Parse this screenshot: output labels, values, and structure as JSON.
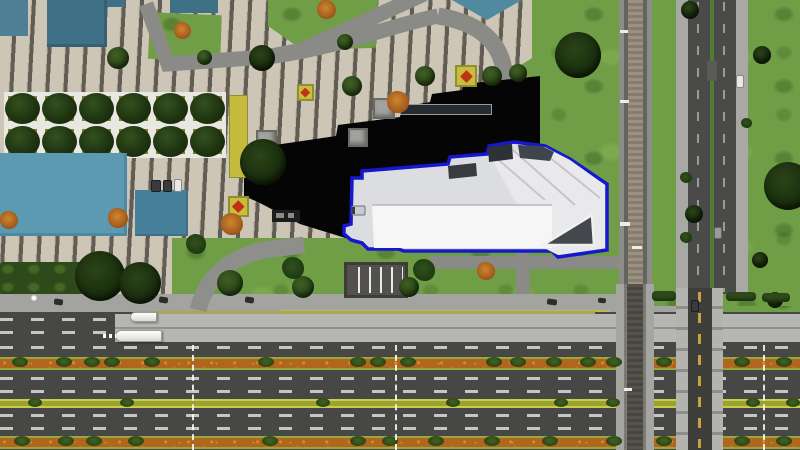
{
  "meta": {
    "view": "aerial-city-simulation",
    "description": "Top-down rendered city block: pedestrian plaza with striped paving, tree park grid, teal rooftops, a black rooftop building, a white building selected with a blue footprint outline, grass field, vertical railway line and divided street on the right, and a wide multi-carriageway boulevard with busway and planted medians at the bottom.",
    "canvas": {
      "width": 800,
      "height": 450
    }
  },
  "selection": {
    "selected_object": "white-building-footprint",
    "outline_color": "#1518cf"
  },
  "palette": {
    "grass": "#6f9e46",
    "plaza_tile": "#cdc5b5",
    "plaza_stripe": "#615d55",
    "path_gray": "#8a8a86",
    "sidewalk": "#a3a39f",
    "asphalt_dark": "#474745",
    "busway_concrete": "#b6b6b4",
    "lane_dash": "#c6c6c4",
    "median_orange": "#b0661e",
    "median_yellow_green": "#9aa231",
    "teal_roof": "#3e7086",
    "cyan_roof": "#5b9ab1",
    "black_roof": "#050505",
    "white_roof": "#ededef",
    "selection_blue": "#1518cf",
    "railway_bed": "#9a9183",
    "overpass_wall": "#b3b3b0",
    "center_line_yellow": "#c8a33d"
  },
  "scene": {
    "counts": {
      "buses": 2,
      "flowerbeds": 3,
      "kiosks": 3,
      "tree_park_cells": 12
    },
    "lane_marker_xs": [
      192,
      395,
      763
    ],
    "sprites": [
      {
        "cls": "kiosk",
        "x": 373,
        "y": 98,
        "w": 22,
        "h": 21
      },
      {
        "cls": "kiosk",
        "x": 348,
        "y": 128,
        "w": 20,
        "h": 19
      },
      {
        "cls": "kiosk",
        "x": 256,
        "y": 130,
        "w": 21,
        "h": 18
      },
      {
        "cls": "bench",
        "x": 400,
        "y": 104,
        "w": 92,
        "h": 11
      },
      {
        "cls": "flowerbed",
        "x": 455,
        "y": 65,
        "w": 22,
        "h": 22
      },
      {
        "cls": "flowerbed",
        "x": 297,
        "y": 84,
        "w": 17,
        "h": 17
      },
      {
        "cls": "flowerbed",
        "x": 228,
        "y": 196,
        "w": 21,
        "h": 21
      },
      {
        "cls": "planter",
        "x": 229,
        "y": 95,
        "w": 19,
        "h": 83
      },
      {
        "cls": "road-patch",
        "x": 707,
        "y": 61,
        "w": 10,
        "h": 20
      },
      {
        "cls": "tree",
        "x": 107,
        "y": 47,
        "w": 22,
        "h": 22
      },
      {
        "cls": "tree",
        "x": 197,
        "y": 50,
        "w": 15,
        "h": 15
      },
      {
        "cls": "tree",
        "x": 337,
        "y": 34,
        "w": 16,
        "h": 16
      },
      {
        "cls": "tree",
        "x": 342,
        "y": 76,
        "w": 20,
        "h": 20
      },
      {
        "cls": "tree",
        "x": 415,
        "y": 66,
        "w": 20,
        "h": 20
      },
      {
        "cls": "tree",
        "x": 482,
        "y": 66,
        "w": 20,
        "h": 20
      },
      {
        "cls": "tree",
        "x": 509,
        "y": 64,
        "w": 18,
        "h": 18
      },
      {
        "cls": "tree-dark",
        "x": 249,
        "y": 45,
        "w": 26,
        "h": 26
      },
      {
        "cls": "tree-dark",
        "x": 240,
        "y": 139,
        "w": 46,
        "h": 46
      },
      {
        "cls": "tree-dark",
        "x": 555,
        "y": 32,
        "w": 46,
        "h": 46
      },
      {
        "cls": "tree-dark",
        "x": 764,
        "y": 162,
        "w": 48,
        "h": 48
      },
      {
        "cls": "tree-dark",
        "x": 681,
        "y": 1,
        "w": 18,
        "h": 18
      },
      {
        "cls": "tree-dark",
        "x": 753,
        "y": 46,
        "w": 18,
        "h": 18
      },
      {
        "cls": "tree-dark",
        "x": 685,
        "y": 205,
        "w": 18,
        "h": 18
      },
      {
        "cls": "tree-dark",
        "x": 752,
        "y": 252,
        "w": 16,
        "h": 16
      },
      {
        "cls": "tree-dark",
        "x": 767,
        "y": 292,
        "w": 16,
        "h": 16
      },
      {
        "cls": "tree-dark",
        "x": 75,
        "y": 251,
        "w": 50,
        "h": 50
      },
      {
        "cls": "tree-dark",
        "x": 119,
        "y": 262,
        "w": 42,
        "h": 42
      },
      {
        "cls": "tree",
        "x": 217,
        "y": 270,
        "w": 26,
        "h": 26
      },
      {
        "cls": "tree",
        "x": 292,
        "y": 276,
        "w": 22,
        "h": 22
      },
      {
        "cls": "tree",
        "x": 399,
        "y": 277,
        "w": 20,
        "h": 20
      },
      {
        "cls": "bush-orange",
        "x": 174,
        "y": 22,
        "w": 17,
        "h": 17
      },
      {
        "cls": "bush-orange",
        "x": 317,
        "y": 0,
        "w": 19,
        "h": 19
      },
      {
        "cls": "bush-orange",
        "x": 387,
        "y": 91,
        "w": 22,
        "h": 22
      },
      {
        "cls": "bush-orange",
        "x": 221,
        "y": 213,
        "w": 22,
        "h": 22
      },
      {
        "cls": "bush-orange",
        "x": 0,
        "y": 211,
        "w": 18,
        "h": 18
      },
      {
        "cls": "bush-orange",
        "x": 108,
        "y": 208,
        "w": 20,
        "h": 20
      },
      {
        "cls": "bush-orange",
        "x": 477,
        "y": 262,
        "w": 18,
        "h": 18
      },
      {
        "cls": "bush-dark",
        "x": 186,
        "y": 234,
        "w": 20,
        "h": 20
      },
      {
        "cls": "bush-dark",
        "x": 282,
        "y": 257,
        "w": 22,
        "h": 22
      },
      {
        "cls": "bush-dark",
        "x": 413,
        "y": 259,
        "w": 22,
        "h": 22
      },
      {
        "cls": "bush-dark",
        "x": 680,
        "y": 172,
        "w": 12,
        "h": 11
      },
      {
        "cls": "bush-dark",
        "x": 680,
        "y": 232,
        "w": 12,
        "h": 11
      },
      {
        "cls": "bush-dark",
        "x": 741,
        "y": 118,
        "w": 11,
        "h": 10
      },
      {
        "cls": "hedge",
        "x": 652,
        "y": 291,
        "w": 24,
        "h": 10
      },
      {
        "cls": "hedge",
        "x": 726,
        "y": 292,
        "w": 30,
        "h": 9
      },
      {
        "cls": "hedge",
        "x": 762,
        "y": 293,
        "w": 28,
        "h": 9
      },
      {
        "cls": "shrub",
        "x": 12,
        "y": 357,
        "w": 16,
        "h": 10
      },
      {
        "cls": "shrub",
        "x": 56,
        "y": 357,
        "w": 16,
        "h": 10
      },
      {
        "cls": "shrub",
        "x": 84,
        "y": 357,
        "w": 16,
        "h": 10
      },
      {
        "cls": "shrub",
        "x": 104,
        "y": 357,
        "w": 16,
        "h": 10
      },
      {
        "cls": "shrub",
        "x": 144,
        "y": 357,
        "w": 16,
        "h": 10
      },
      {
        "cls": "shrub",
        "x": 258,
        "y": 357,
        "w": 16,
        "h": 10
      },
      {
        "cls": "shrub",
        "x": 350,
        "y": 357,
        "w": 16,
        "h": 10
      },
      {
        "cls": "shrub",
        "x": 370,
        "y": 357,
        "w": 16,
        "h": 10
      },
      {
        "cls": "shrub",
        "x": 400,
        "y": 357,
        "w": 16,
        "h": 10
      },
      {
        "cls": "shrub",
        "x": 486,
        "y": 357,
        "w": 16,
        "h": 10
      },
      {
        "cls": "shrub",
        "x": 510,
        "y": 357,
        "w": 16,
        "h": 10
      },
      {
        "cls": "shrub",
        "x": 546,
        "y": 357,
        "w": 16,
        "h": 10
      },
      {
        "cls": "shrub",
        "x": 580,
        "y": 357,
        "w": 16,
        "h": 10
      },
      {
        "cls": "shrub",
        "x": 606,
        "y": 357,
        "w": 16,
        "h": 10
      },
      {
        "cls": "shrub",
        "x": 656,
        "y": 357,
        "w": 16,
        "h": 10
      },
      {
        "cls": "shrub",
        "x": 734,
        "y": 357,
        "w": 16,
        "h": 10
      },
      {
        "cls": "shrub",
        "x": 776,
        "y": 357,
        "w": 16,
        "h": 10
      },
      {
        "cls": "shrub",
        "x": 28,
        "y": 398,
        "w": 14,
        "h": 9
      },
      {
        "cls": "shrub",
        "x": 120,
        "y": 398,
        "w": 14,
        "h": 9
      },
      {
        "cls": "shrub",
        "x": 316,
        "y": 398,
        "w": 14,
        "h": 9
      },
      {
        "cls": "shrub",
        "x": 446,
        "y": 398,
        "w": 14,
        "h": 9
      },
      {
        "cls": "shrub",
        "x": 554,
        "y": 398,
        "w": 14,
        "h": 9
      },
      {
        "cls": "shrub",
        "x": 606,
        "y": 398,
        "w": 14,
        "h": 9
      },
      {
        "cls": "shrub",
        "x": 746,
        "y": 398,
        "w": 14,
        "h": 9
      },
      {
        "cls": "shrub",
        "x": 786,
        "y": 398,
        "w": 14,
        "h": 9
      },
      {
        "cls": "shrub",
        "x": 14,
        "y": 436,
        "w": 16,
        "h": 10
      },
      {
        "cls": "shrub",
        "x": 58,
        "y": 436,
        "w": 16,
        "h": 10
      },
      {
        "cls": "shrub",
        "x": 86,
        "y": 436,
        "w": 16,
        "h": 10
      },
      {
        "cls": "shrub",
        "x": 128,
        "y": 436,
        "w": 16,
        "h": 10
      },
      {
        "cls": "shrub",
        "x": 262,
        "y": 436,
        "w": 16,
        "h": 10
      },
      {
        "cls": "shrub",
        "x": 350,
        "y": 436,
        "w": 16,
        "h": 10
      },
      {
        "cls": "shrub",
        "x": 382,
        "y": 436,
        "w": 16,
        "h": 10
      },
      {
        "cls": "shrub",
        "x": 428,
        "y": 436,
        "w": 16,
        "h": 10
      },
      {
        "cls": "shrub",
        "x": 484,
        "y": 436,
        "w": 16,
        "h": 10
      },
      {
        "cls": "shrub",
        "x": 542,
        "y": 436,
        "w": 16,
        "h": 10
      },
      {
        "cls": "shrub",
        "x": 606,
        "y": 436,
        "w": 16,
        "h": 10
      },
      {
        "cls": "shrub",
        "x": 656,
        "y": 436,
        "w": 16,
        "h": 10
      },
      {
        "cls": "shrub",
        "x": 734,
        "y": 436,
        "w": 16,
        "h": 10
      },
      {
        "cls": "shrub",
        "x": 776,
        "y": 436,
        "w": 16,
        "h": 10
      },
      {
        "cls": "bus",
        "n": "articulated-bus",
        "i": true,
        "x": 130,
        "y": 312,
        "w": 27,
        "h": 10
      },
      {
        "cls": "bus",
        "n": "articulated-bus",
        "i": true,
        "x": 115,
        "y": 330,
        "w": 47,
        "h": 12
      },
      {
        "cls": "dots",
        "n": "lane-dots",
        "x": 103,
        "y": 334,
        "w": 13,
        "h": 4
      },
      {
        "cls": "car-white",
        "n": "car",
        "i": true,
        "x": 736,
        "y": 75,
        "w": 8,
        "h": 13
      },
      {
        "cls": "car-gray",
        "n": "car",
        "i": true,
        "x": 714,
        "y": 227,
        "w": 8,
        "h": 12
      },
      {
        "cls": "car-dark",
        "n": "car",
        "i": true,
        "x": 691,
        "y": 300,
        "w": 8,
        "h": 12
      },
      {
        "cls": "car-dark",
        "n": "parked-car",
        "i": true,
        "x": 151,
        "y": 180,
        "w": 10,
        "h": 12
      },
      {
        "cls": "car-dark",
        "n": "parked-car",
        "i": true,
        "x": 163,
        "y": 180,
        "w": 9,
        "h": 12
      },
      {
        "cls": "car-white",
        "n": "parked-van",
        "i": true,
        "x": 174,
        "y": 179,
        "w": 8,
        "h": 13
      },
      {
        "cls": "bike",
        "n": "bicycle",
        "x": 54,
        "y": 299,
        "w": 9,
        "h": 6
      },
      {
        "cls": "bike",
        "n": "bicycle",
        "x": 159,
        "y": 297,
        "w": 9,
        "h": 6
      },
      {
        "cls": "bike",
        "n": "bicycle",
        "x": 245,
        "y": 297,
        "w": 9,
        "h": 6
      },
      {
        "cls": "bike",
        "n": "bicycle",
        "x": 547,
        "y": 299,
        "w": 10,
        "h": 6
      },
      {
        "cls": "bike",
        "n": "bicycle",
        "x": 598,
        "y": 298,
        "w": 8,
        "h": 5
      },
      {
        "cls": "lamp",
        "n": "street-lamp",
        "x": 31,
        "y": 295,
        "w": 6,
        "h": 6
      },
      {
        "cls": "marker",
        "n": "median-crossing-marker",
        "x": 192,
        "y": 345,
        "w": 2,
        "h": 105
      },
      {
        "cls": "marker",
        "n": "median-crossing-marker",
        "x": 395,
        "y": 345,
        "w": 2,
        "h": 105
      },
      {
        "cls": "marker",
        "n": "median-crossing-marker",
        "x": 763,
        "y": 345,
        "w": 2,
        "h": 105
      },
      {
        "cls": "rail-tie",
        "n": "rail-marker",
        "x": 620,
        "y": 30,
        "w": 8,
        "h": 3
      },
      {
        "cls": "rail-tie",
        "n": "rail-marker",
        "x": 620,
        "y": 100,
        "w": 9,
        "h": 3
      },
      {
        "cls": "rail-tie",
        "n": "rail-marker",
        "x": 620,
        "y": 222,
        "w": 10,
        "h": 4
      },
      {
        "cls": "rail-tie",
        "n": "rail-marker",
        "x": 632,
        "y": 246,
        "w": 10,
        "h": 3
      },
      {
        "cls": "rail-tie",
        "n": "rail-marker",
        "x": 624,
        "y": 388,
        "w": 8,
        "h": 3
      }
    ]
  }
}
